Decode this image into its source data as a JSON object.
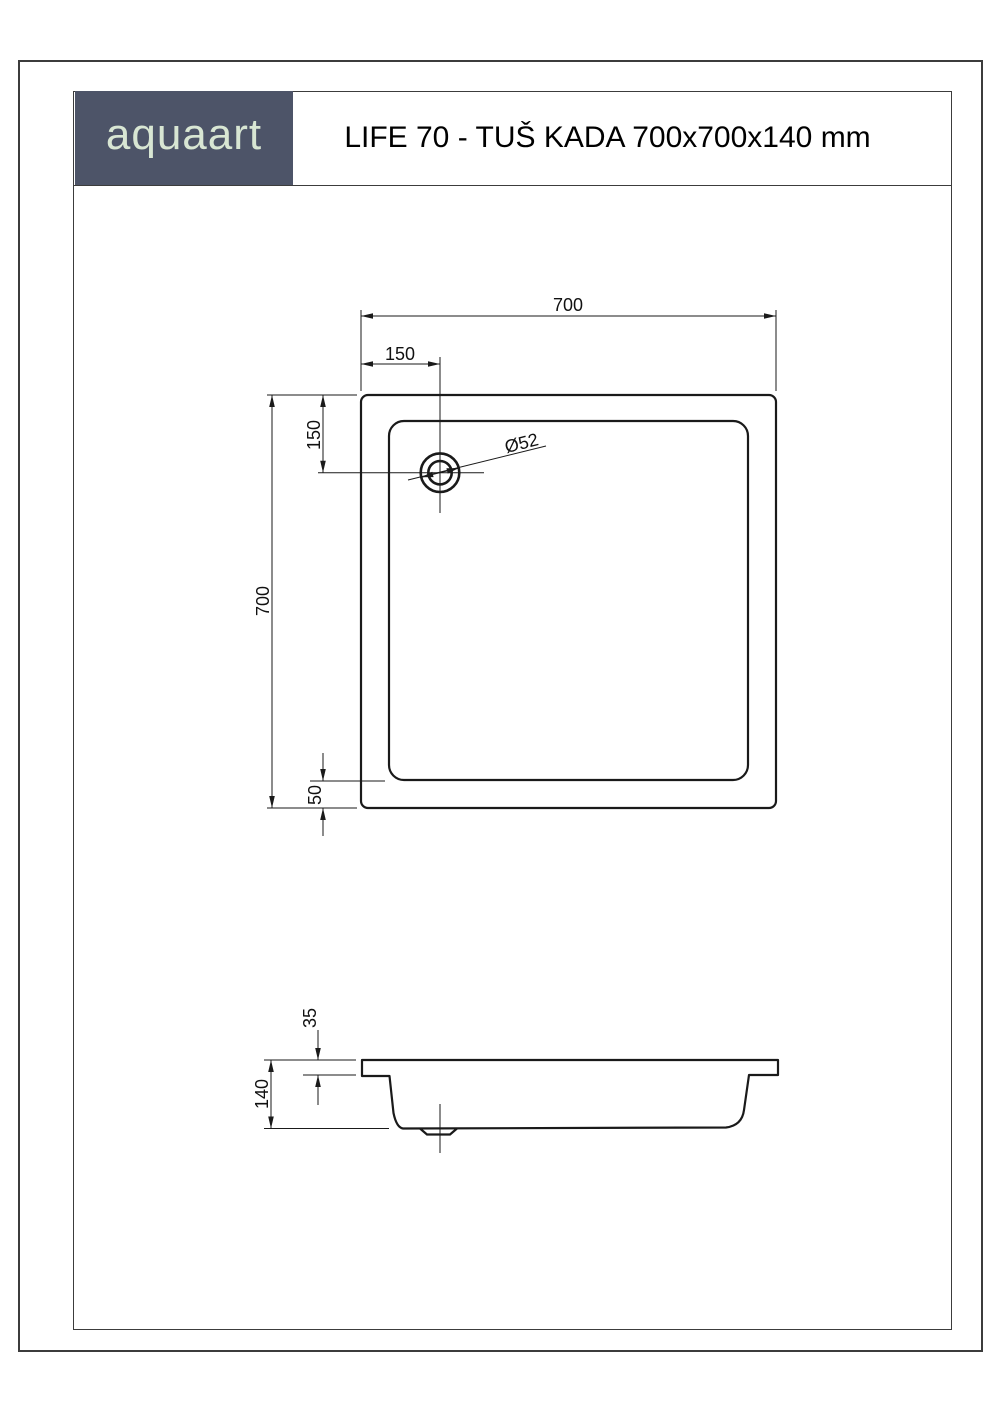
{
  "header": {
    "logo_text": "aquaart",
    "title": "LIFE 70 - TUŠ KADA 700x700x140 mm"
  },
  "colors": {
    "logo_background": "#4d5468",
    "logo_text_color": "#d8e6d3",
    "drawing_line_color": "#1a1a1a",
    "frame_border_color": "#3c3c3c"
  },
  "top_view": {
    "dim_overall_width": "700",
    "dim_drain_offset_x": "150",
    "dim_drain_offset_y": "150",
    "dim_overall_height": "700",
    "dim_bottom_rim": "50",
    "dim_drain_diameter": "Ø52"
  },
  "side_view": {
    "dim_rim_height": "35",
    "dim_total_height": "140"
  }
}
